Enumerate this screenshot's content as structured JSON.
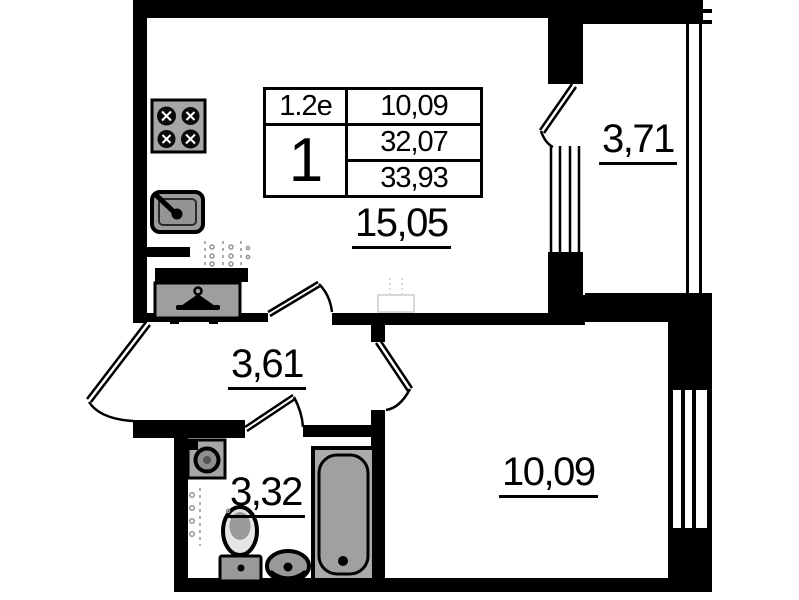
{
  "title": "Apartment floor plan",
  "stamp": {
    "unit_type": "1.2е",
    "rooms": "1",
    "values": [
      "10,09",
      "32,07",
      "33,93"
    ]
  },
  "room_labels": {
    "kitchen_living": "15,05",
    "balcony": "3,71",
    "hallway": "3,61",
    "bathroom": "3,32",
    "bedroom": "10,09"
  },
  "icons": [
    "stove-icon",
    "kitchen-sink-icon",
    "hanger-icon",
    "washing-machine-icon",
    "toilet-icon",
    "washbasin-icon",
    "bathtub-icon"
  ],
  "colors": {
    "wall": "#000000",
    "background": "#ffffff",
    "fixture_fill": "#a6a6a6",
    "fixture_dark": "#8e8e8e",
    "vent": "#949494",
    "faint": "#cccccc"
  }
}
